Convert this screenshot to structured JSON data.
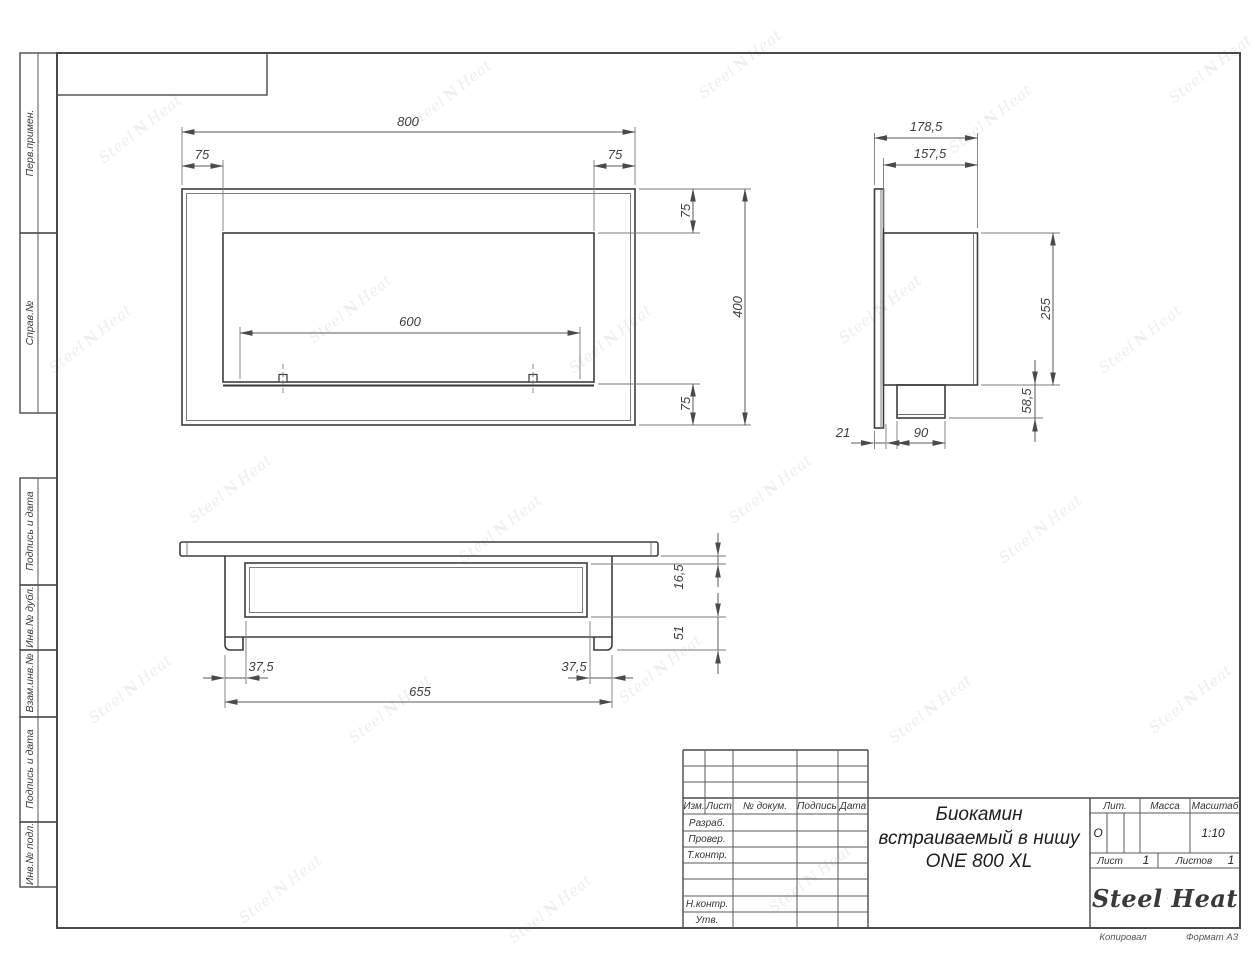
{
  "watermark": {
    "steel": "Steel",
    "heat": "Heat",
    "flame_glyph": "N"
  },
  "sidebar": {
    "boxes": [
      {
        "label": "Перв.примен."
      },
      {
        "label": "Справ.№"
      },
      {
        "label": "Подпись и дата"
      },
      {
        "label": "Инв.№ дубл."
      },
      {
        "label": "Взам.инв.№"
      },
      {
        "label": "Подпись и дата"
      },
      {
        "label": "Инв.№ подл."
      }
    ]
  },
  "front_view": {
    "dim_width": "800",
    "dim_offset_left": "75",
    "dim_offset_right": "75",
    "dim_inset_top": "75",
    "dim_height": "400",
    "dim_inset_bottom": "75",
    "dim_burner_length": "600"
  },
  "side_view": {
    "dim_depth_total": "178,5",
    "dim_depth_body": "157,5",
    "dim_height_inner": "255",
    "dim_height_bottom": "58,5",
    "dim_flange": "21",
    "dim_box": "90"
  },
  "bottom_view": {
    "dim_glass_offset": "16,5",
    "dim_depth_inner": "51",
    "dim_margin_left": "37,5",
    "dim_margin_right": "37,5",
    "dim_body_width": "655"
  },
  "title_block": {
    "col_izm": "Изм.",
    "col_list": "Лист",
    "col_doc": "№ докум.",
    "col_sign": "Подпись",
    "col_date": "Дата",
    "row_razrab": "Разраб.",
    "row_prover": "Провер.",
    "row_tkontr": "Т.контр.",
    "row_nkontr": "Н.контр.",
    "row_utv": "Утв.",
    "title_line1": "Биокамин",
    "title_line2": "встраиваемый в нишу",
    "title_line3": "ONE 800 XL",
    "lit_label": "Лит.",
    "lit_value": "О",
    "mass_label": "Масса",
    "scale_label": "Масштаб",
    "scale_value": "1:10",
    "sheet_label": "Лист",
    "sheet_value": "1",
    "sheets_label": "Листов",
    "sheets_value": "1",
    "logo_steel": "Steel",
    "logo_heat": "Heat"
  },
  "footer": {
    "copied": "Копировал",
    "format": "Формат А3"
  }
}
